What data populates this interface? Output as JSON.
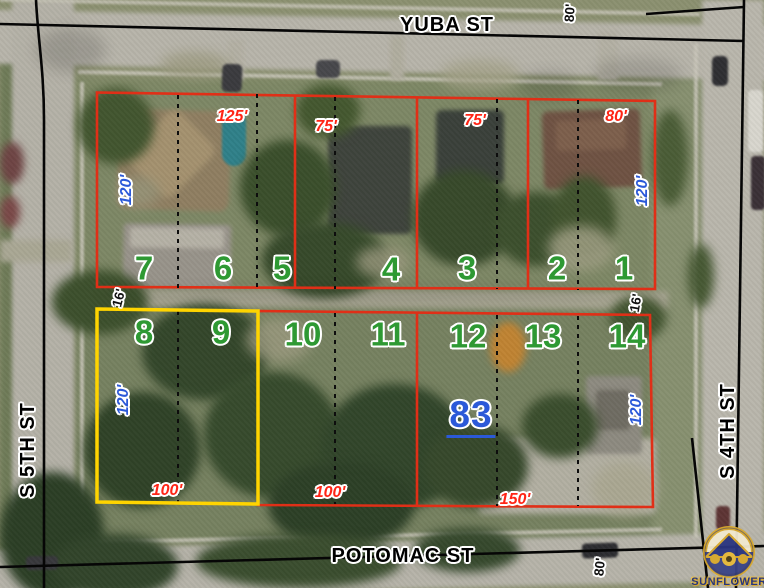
{
  "streets": {
    "top": "YUBA ST",
    "bottom": "POTOMAC ST",
    "left": "S 5TH ST",
    "right": "S 4TH ST"
  },
  "parcel_highlight": {
    "number": "83",
    "x": 471,
    "y": 417
  },
  "lot_numbers": [
    {
      "label": "7",
      "x": 144,
      "y": 268
    },
    {
      "label": "6",
      "x": 223,
      "y": 268
    },
    {
      "label": "5",
      "x": 282,
      "y": 268
    },
    {
      "label": "4",
      "x": 391,
      "y": 269
    },
    {
      "label": "3",
      "x": 467,
      "y": 268
    },
    {
      "label": "2",
      "x": 557,
      "y": 268
    },
    {
      "label": "1",
      "x": 624,
      "y": 268
    },
    {
      "label": "8",
      "x": 144,
      "y": 332
    },
    {
      "label": "9",
      "x": 221,
      "y": 332
    },
    {
      "label": "10",
      "x": 303,
      "y": 334
    },
    {
      "label": "11",
      "x": 388,
      "y": 334
    },
    {
      "label": "12",
      "x": 468,
      "y": 336
    },
    {
      "label": "13",
      "x": 543,
      "y": 336
    },
    {
      "label": "14",
      "x": 627,
      "y": 336
    }
  ],
  "dimensions_red": [
    {
      "label": "125'",
      "x": 232,
      "y": 117
    },
    {
      "label": "75'",
      "x": 326,
      "y": 127
    },
    {
      "label": "75'",
      "x": 475,
      "y": 121
    },
    {
      "label": "80'",
      "x": 616,
      "y": 117
    },
    {
      "label": "100'",
      "x": 167,
      "y": 491
    },
    {
      "label": "100'",
      "x": 330,
      "y": 493
    },
    {
      "label": "150'",
      "x": 515,
      "y": 500
    }
  ],
  "dimensions_blue": [
    {
      "label": "120'",
      "x": 127,
      "y": 190,
      "rot": -90
    },
    {
      "label": "120'",
      "x": 643,
      "y": 191,
      "rot": -90
    },
    {
      "label": "120'",
      "x": 124,
      "y": 400,
      "rot": -90
    },
    {
      "label": "120'",
      "x": 637,
      "y": 410,
      "rot": -90
    }
  ],
  "dimensions_black": [
    {
      "label": "80'",
      "x": 570,
      "y": 13,
      "rot": -86
    },
    {
      "label": "16'",
      "x": 119,
      "y": 298,
      "rot": -76
    },
    {
      "label": "16'",
      "x": 636,
      "y": 303,
      "rot": -80
    },
    {
      "label": "80'",
      "x": 600,
      "y": 567,
      "rot": -84
    }
  ],
  "logo": {
    "name": "SUNFLOWER"
  },
  "colors": {
    "parcel_outline": "#e02f17",
    "highlight_outline": "#ffd400",
    "lot_number": "#2e9933",
    "dimension_red": "#ff2516",
    "dimension_blue": "#2b59d8",
    "highlight_number": "#2b59d8",
    "street_label": "#000000"
  }
}
